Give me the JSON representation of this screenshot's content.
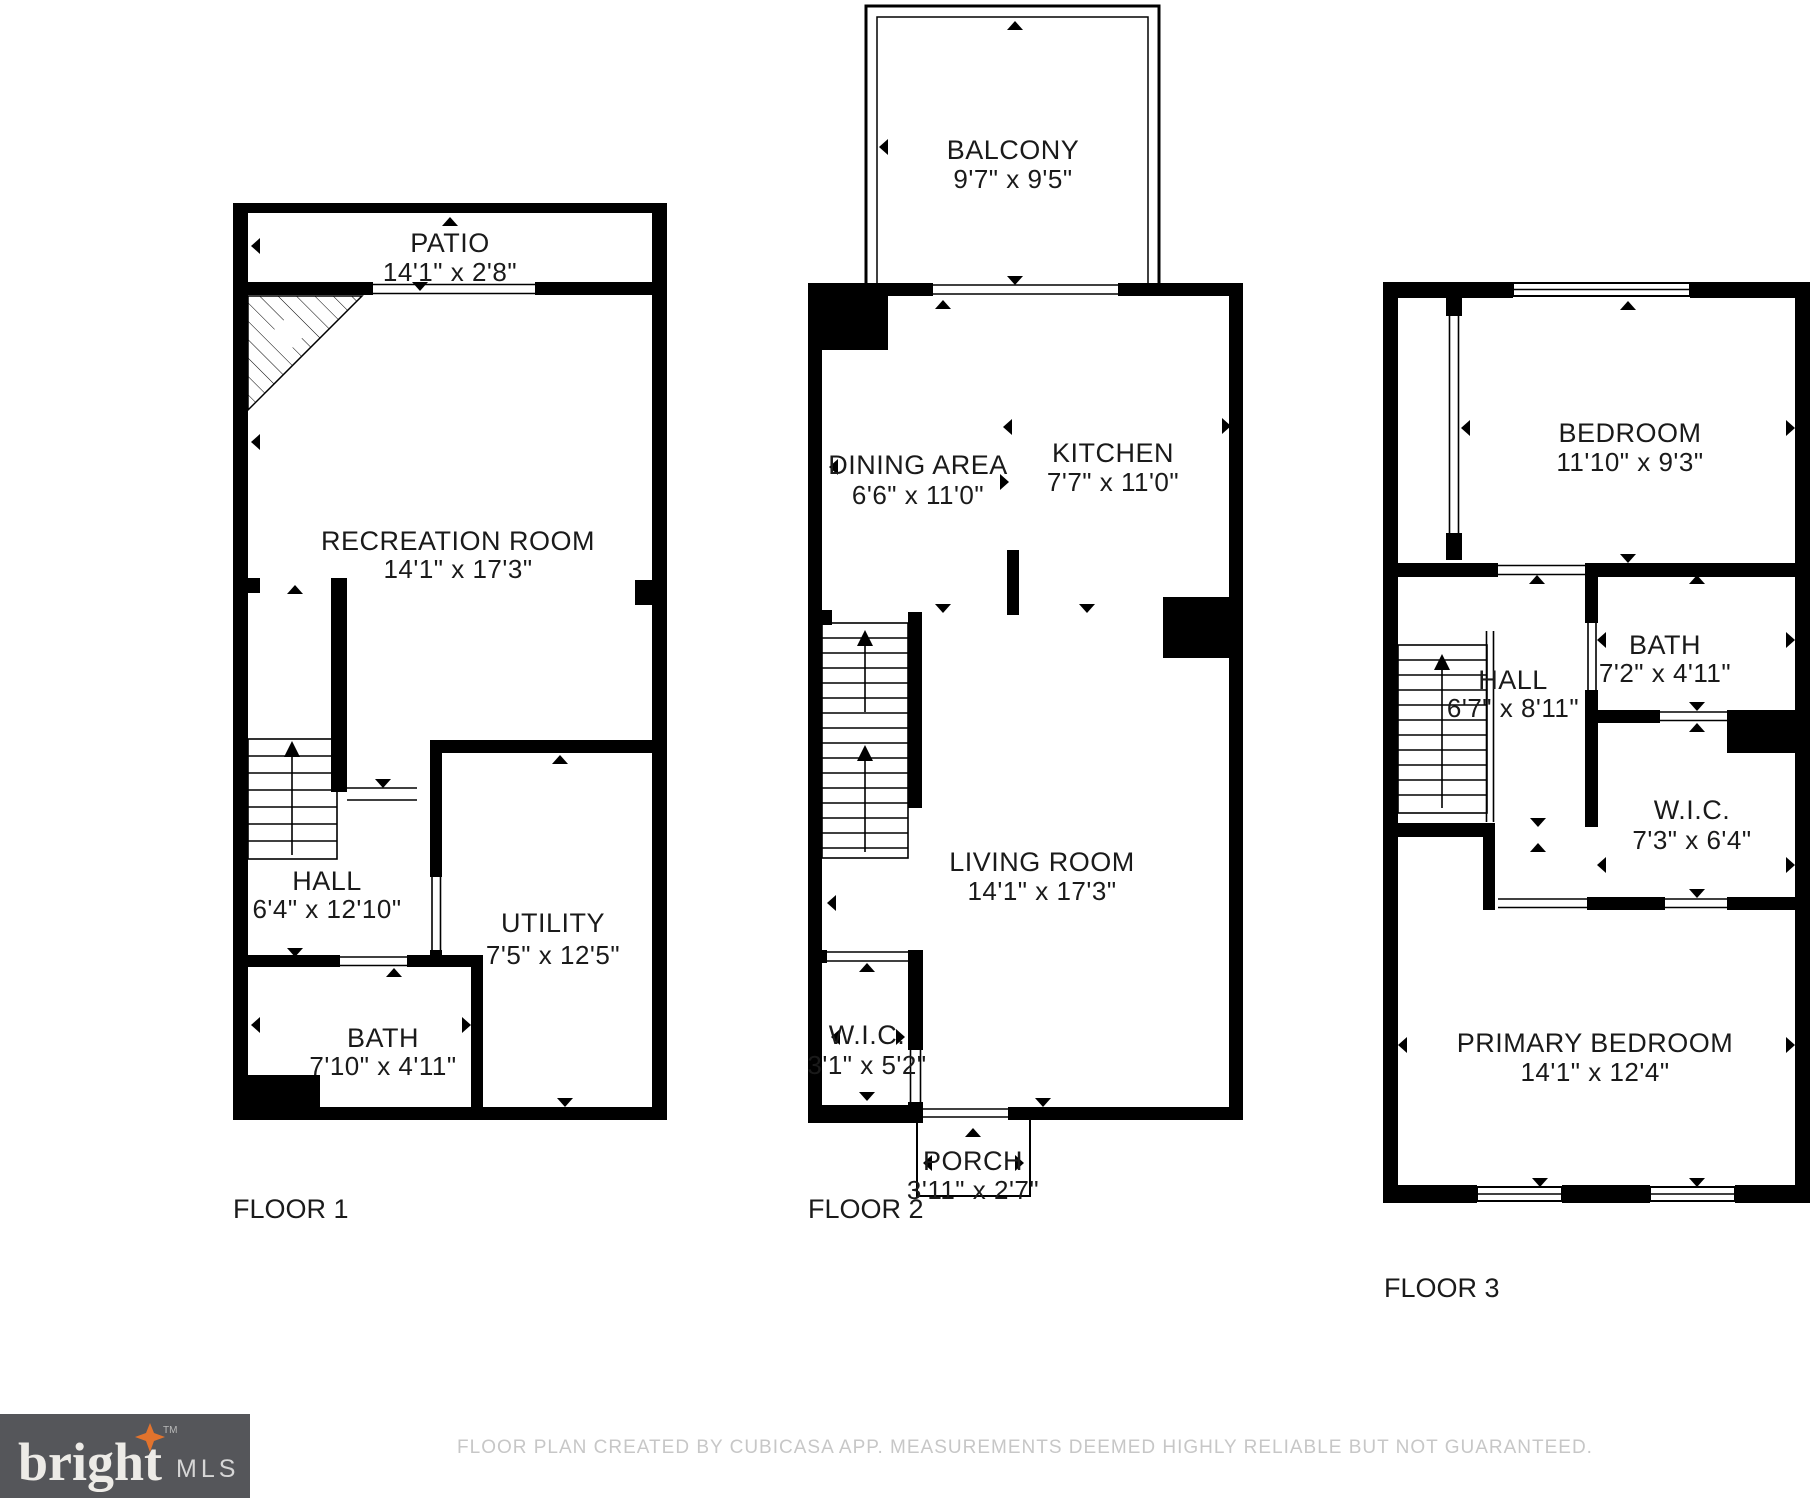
{
  "branding": {
    "logo_word": "bright",
    "logo_tm": "TM",
    "logo_mls": "MLS",
    "logo_bg_color": "#55565a",
    "logo_star_color": "#e2732d"
  },
  "footer": {
    "disclaimer": "FLOOR PLAN CREATED BY CUBICASA APP. MEASUREMENTS DEEMED HIGHLY RELIABLE BUT NOT GUARANTEED."
  },
  "colors": {
    "wall": "#000000",
    "background": "#ffffff",
    "label_text": "#1a1a1a",
    "footer_text": "#c7c7c7"
  },
  "floors": [
    {
      "label": "FLOOR 1",
      "rooms": [
        {
          "name": "PATIO",
          "dims": "14'1\" x 2'8\""
        },
        {
          "name": "RECREATION ROOM",
          "dims": "14'1\" x 17'3\""
        },
        {
          "name": "HALL",
          "dims": "6'4\" x 12'10\""
        },
        {
          "name": "UTILITY",
          "dims": "7'5\" x 12'5\""
        },
        {
          "name": "BATH",
          "dims": "7'10\" x 4'11\""
        }
      ]
    },
    {
      "label": "FLOOR 2",
      "rooms": [
        {
          "name": "BALCONY",
          "dims": "9'7\" x 9'5\""
        },
        {
          "name": "DINING AREA",
          "dims": "6'6\" x 11'0\""
        },
        {
          "name": "KITCHEN",
          "dims": "7'7\" x 11'0\""
        },
        {
          "name": "LIVING ROOM",
          "dims": "14'1\" x 17'3\""
        },
        {
          "name": "W.I.C.",
          "dims": "3'1\" x 5'2\""
        },
        {
          "name": "PORCH",
          "dims": "3'11\" x 2'7\""
        }
      ]
    },
    {
      "label": "FLOOR 3",
      "rooms": [
        {
          "name": "BEDROOM",
          "dims": "11'10\" x 9'3\""
        },
        {
          "name": "HALL",
          "dims": "6'7\" x 8'11\""
        },
        {
          "name": "BATH",
          "dims": "7'2\" x 4'11\""
        },
        {
          "name": "W.I.C.",
          "dims": "7'3\" x 6'4\""
        },
        {
          "name": "PRIMARY BEDROOM",
          "dims": "14'1\" x 12'4\""
        }
      ]
    }
  ]
}
